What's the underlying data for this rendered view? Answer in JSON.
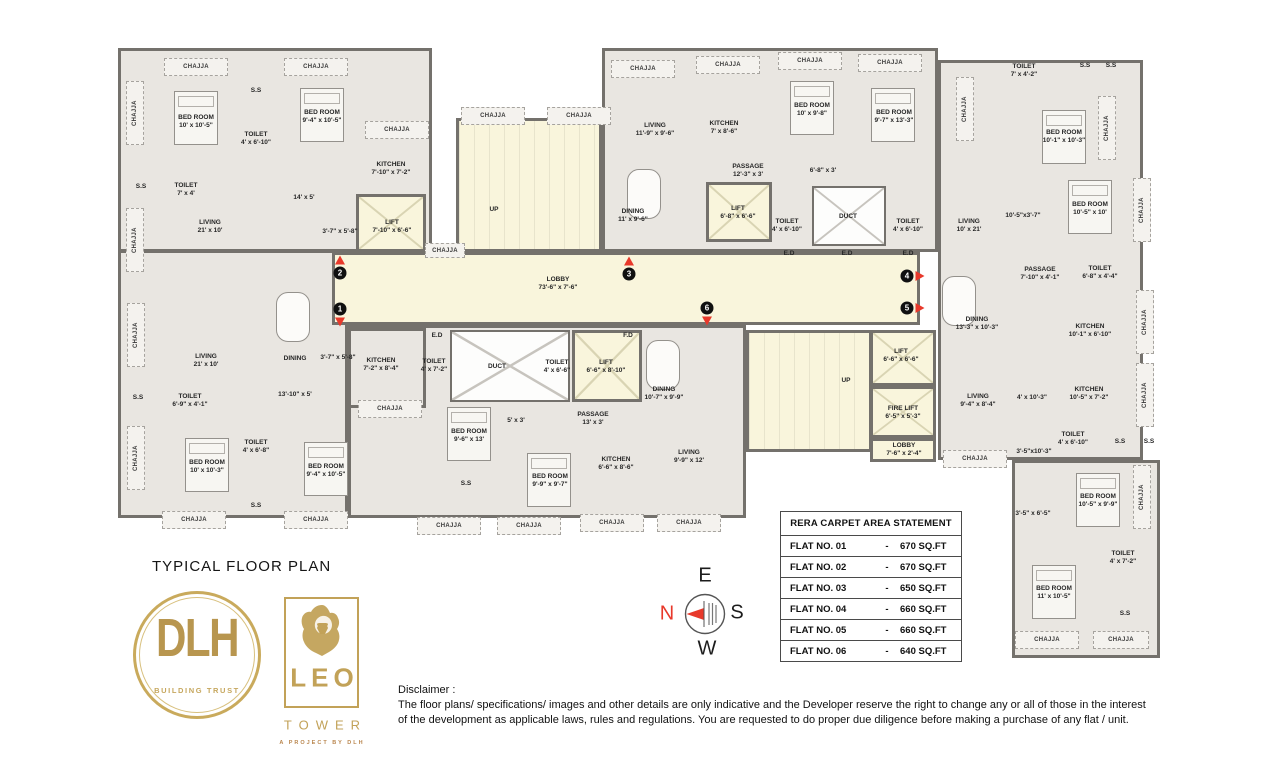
{
  "title": "TYPICAL FLOOR PLAN",
  "plan": {
    "chajja": "CHAJJA",
    "ss": "S.S",
    "rooms": [
      {
        "name": "BED ROOM",
        "dim": "10' x 10'-5\""
      },
      {
        "name": "BED ROOM",
        "dim": "9'-4\" x 10'-5\""
      },
      {
        "name": "TOILET",
        "dim": "4' x 6'-10\""
      },
      {
        "name": "KITCHEN",
        "dim": "7'-10\" x 7'-2\""
      },
      {
        "name": "TOILET",
        "dim": "7' x 4'"
      },
      {
        "name": "LIVING",
        "dim": "21' x 10'"
      },
      {
        "name": "LIFT",
        "dim": "7'-10\" x 6'-6\""
      },
      {
        "name": "LIVING",
        "dim": "11'-9\" x 9'-6\""
      },
      {
        "name": "KITCHEN",
        "dim": "7' x 8'-6\""
      },
      {
        "name": "BED ROOM",
        "dim": "10' x 9'-8\""
      },
      {
        "name": "BED ROOM",
        "dim": "9'-7\" x 13'-3\""
      },
      {
        "name": "PASSAGE",
        "dim": "12'-3\" x 3'"
      },
      {
        "name": "DINING",
        "dim": "11' x 9'-6\""
      },
      {
        "name": "LIFT",
        "dim": "6'-8\" x 6'-6\""
      },
      {
        "name": "TOILET",
        "dim": "4' x 6'-10\""
      },
      {
        "name": "TOILET",
        "dim": "4' x 6'-10\""
      },
      {
        "name": "LIVING",
        "dim": "10' x 21'"
      },
      {
        "name": "TOILET",
        "dim": "7' x 4'-2\""
      },
      {
        "name": "BED ROOM",
        "dim": "10'-1\" x 10'-3\""
      },
      {
        "name": "BED ROOM",
        "dim": "10'-5\" x 10'"
      },
      {
        "name": "PASSAGE",
        "dim": "7'-10\" x 4'-1\""
      },
      {
        "name": "TOILET",
        "dim": "6'-8\" x 4'-4\""
      },
      {
        "name": "DINING",
        "dim": "13'-3\" x 10'-3\""
      },
      {
        "name": "KITCHEN",
        "dim": "10'-1\" x 6'-10\""
      },
      {
        "name": "KITCHEN",
        "dim": "10'-5\" x 7'-2\""
      },
      {
        "name": "LIVING",
        "dim": "9'-4\" x 8'-4\""
      },
      {
        "name": "TOILET",
        "dim": "4' x 6'-10\""
      },
      {
        "name": "BED ROOM",
        "dim": "10'-5\" x 9'-9\""
      },
      {
        "name": "BED ROOM",
        "dim": "11' x 10'-5\""
      },
      {
        "name": "TOILET",
        "dim": "4' x 7'-2\""
      },
      {
        "name": "BED ROOM",
        "dim": "9'-6\" x 13'"
      },
      {
        "name": "BED ROOM",
        "dim": "9'-9\" x 9'-7\""
      },
      {
        "name": "KITCHEN",
        "dim": "6'-6\" x 8'-6\""
      },
      {
        "name": "LIVING",
        "dim": "9'-9\" x 12'"
      },
      {
        "name": "DINING",
        "dim": "10'-7\" x 9'-9\""
      },
      {
        "name": "LIFT",
        "dim": "6'-6\" x 8'-10\""
      },
      {
        "name": "TOILET",
        "dim": "4' x 7'-2\""
      },
      {
        "name": "TOILET",
        "dim": "4' x 6'-6\""
      },
      {
        "name": "PASSAGE",
        "dim": "13' x 3'"
      },
      {
        "name": "LIFT",
        "dim": "6'-6\" x 6'-6\""
      },
      {
        "name": "FIRE LIFT",
        "dim": "6'-5\" x 5'-3\""
      },
      {
        "name": "LOBBY",
        "dim": "7'-6\" x 2'-4\""
      },
      {
        "name": "KITCHEN",
        "dim": "7'-2\" x 8'-4\""
      },
      {
        "name": "LIVING",
        "dim": "21' x 10'"
      },
      {
        "name": "TOILET",
        "dim": "6'-9\" x 4'-1\""
      },
      {
        "name": "TOILET",
        "dim": "4' x 6'-8\""
      },
      {
        "name": "BED ROOM",
        "dim": "10' x 10'-3\""
      },
      {
        "name": "BED ROOM",
        "dim": "9'-4\" x 10'-5\""
      },
      {
        "name": "LOBBY",
        "dim": "73'-6\" x 7'-6\""
      }
    ],
    "texts": [
      "UP",
      "UP",
      "DUCT",
      "DUCT",
      "E.D",
      "F.D",
      "E.D",
      "E.D",
      "E.D",
      "DINING",
      "14' x 5'",
      "3'-7\" x 5'-8\"",
      "3'-7\" x 5'-8\"",
      "6'-8\" x 3'",
      "13'-10\" x 5'",
      "5' x 3'",
      "10'-5\"x3'-7\"",
      "4' x 10'-3\"",
      "3'-5\"x10'-3\"",
      "3'-5\" x 6'-5\""
    ],
    "markers": [
      {
        "n": "1"
      },
      {
        "n": "2"
      },
      {
        "n": "3"
      },
      {
        "n": "4"
      },
      {
        "n": "5"
      },
      {
        "n": "6"
      }
    ]
  },
  "compass": {
    "n": "N",
    "e": "E",
    "s": "S",
    "w": "W"
  },
  "logos": {
    "dlh": {
      "name": "DLH",
      "tagline": "BUILDING TRUST"
    },
    "leo": {
      "name": "LEO",
      "sub": "TOWER",
      "tagline": "A PROJECT BY DLH"
    }
  },
  "table": {
    "header": "RERA CARPET AREA STATEMENT",
    "rows": [
      {
        "flat": "FLAT NO. 01",
        "sep": "-",
        "area": "670 SQ.FT"
      },
      {
        "flat": "FLAT NO. 02",
        "sep": "-",
        "area": "670 SQ.FT"
      },
      {
        "flat": "FLAT NO. 03",
        "sep": "-",
        "area": "650 SQ.FT"
      },
      {
        "flat": "FLAT NO. 04",
        "sep": "-",
        "area": "660 SQ.FT"
      },
      {
        "flat": "FLAT NO. 05",
        "sep": "-",
        "area": "660 SQ.FT"
      },
      {
        "flat": "FLAT NO. 06",
        "sep": "-",
        "area": "640 SQ.FT"
      }
    ]
  },
  "disclaimer": {
    "label": "Disclaimer :",
    "text": "The floor plans/ specifications/ images and other details are only indicative and the Developer reserve the right to change any or all of those in the interest of the development as applicable laws, rules and regulations. You are requested to do proper due diligence before making a purchase of any flat / unit."
  }
}
